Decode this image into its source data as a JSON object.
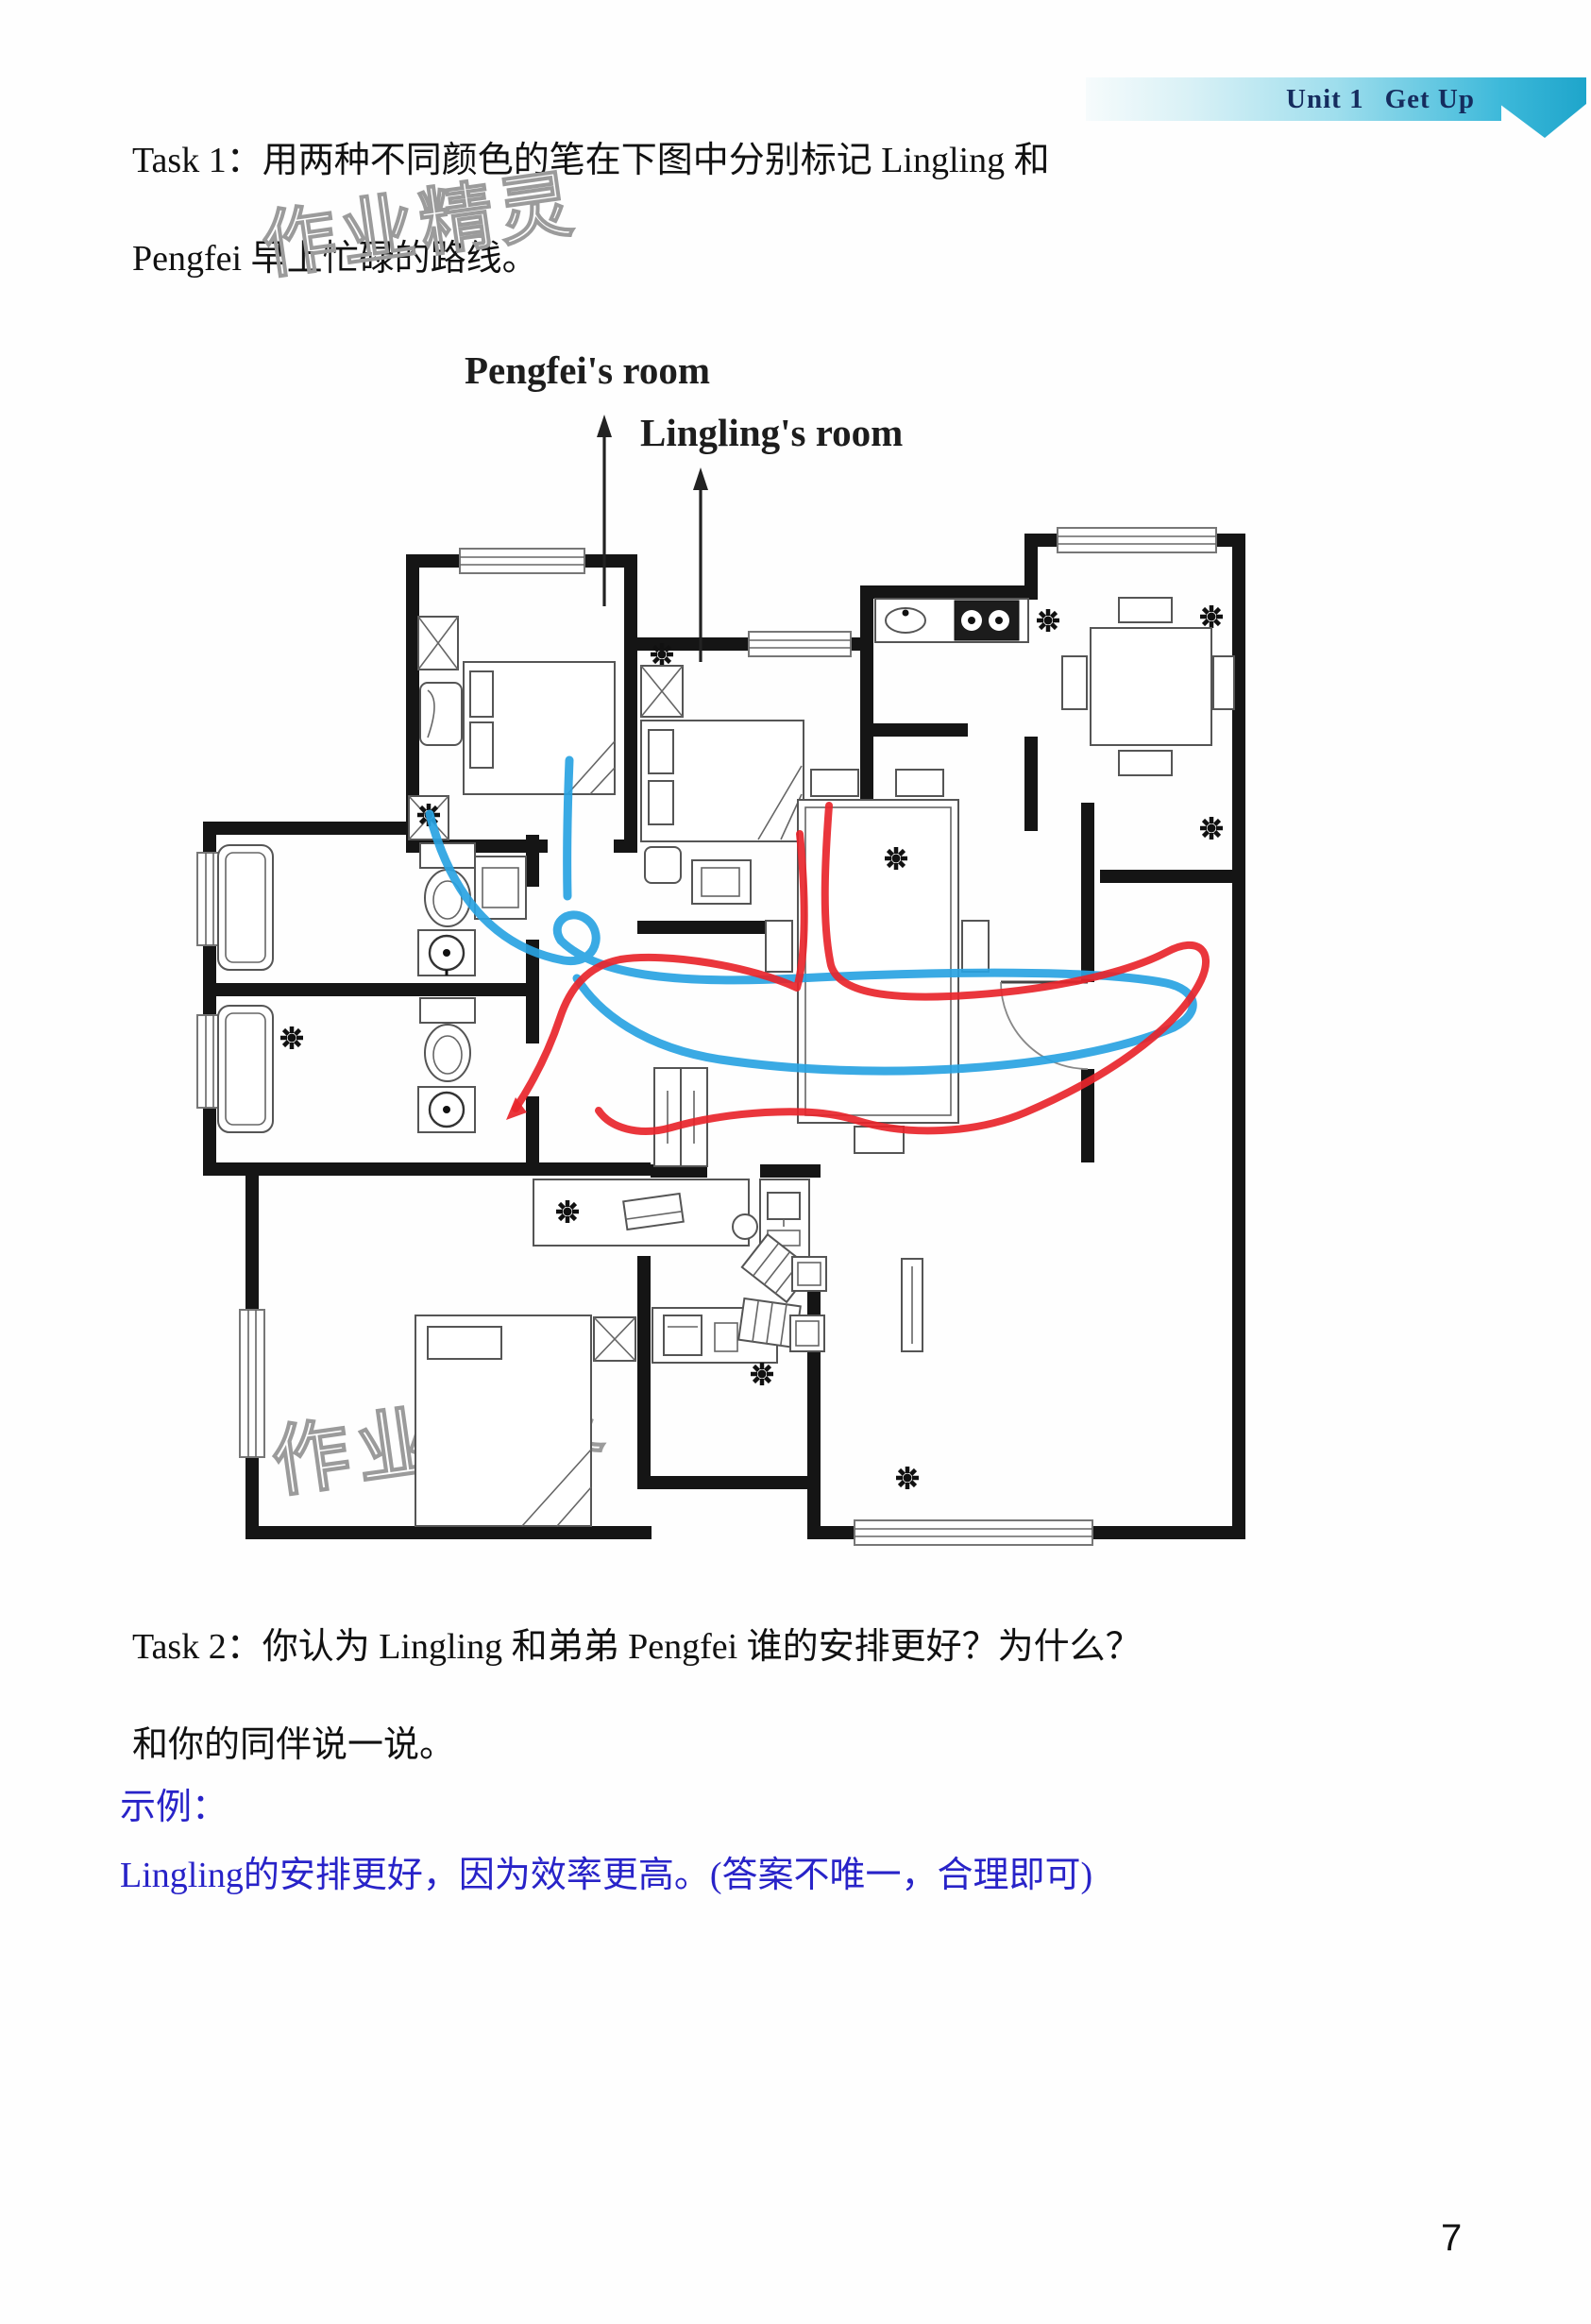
{
  "header": {
    "unit_label": "Unit 1",
    "unit_title": "Get Up"
  },
  "task1": {
    "line1": "Task 1：用两种不同颜色的笔在下图中分别标记 Lingling 和",
    "line2": "Pengfei 早上忙碌的路线。"
  },
  "floorplan": {
    "label_pengfei": "Pengfei's room",
    "label_lingling": "Lingling's room",
    "route_colors": {
      "pengfei_blue": "#29a3e2",
      "lingling_red": "#e8252b"
    }
  },
  "task2": {
    "line1": "Task 2：你认为 Lingling 和弟弟 Pengfei 谁的安排更好？为什么？",
    "line2": "和你的同伴说一说。"
  },
  "example": {
    "label": "示例：",
    "answer": "Lingling的安排更好，因为效率更高。(答案不唯一，合理即可)",
    "color": "#2823c8"
  },
  "watermark": {
    "text": "作业精灵"
  },
  "page": {
    "number": "7"
  }
}
